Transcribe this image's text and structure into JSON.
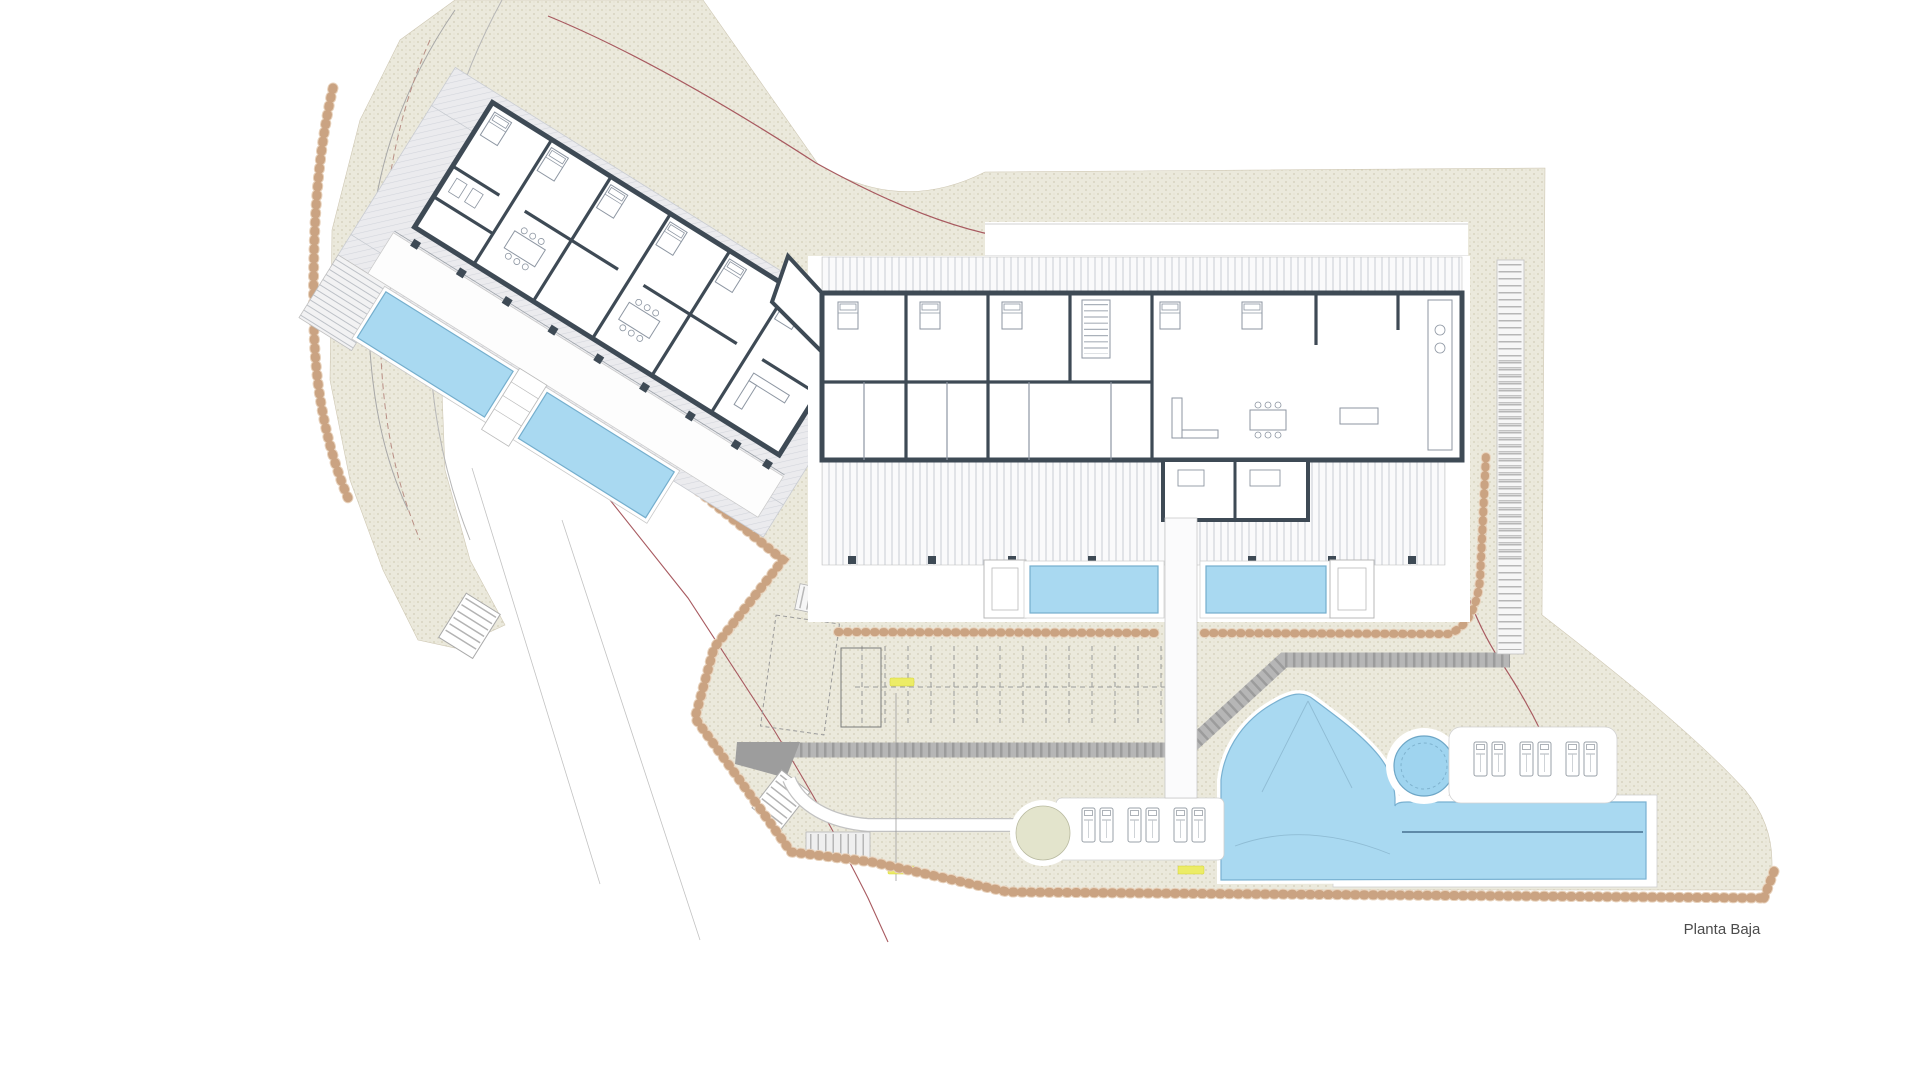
{
  "title": {
    "label": "Planta Baja"
  },
  "plan": {
    "kind": "residential ground-floor site plan",
    "west_block": {
      "name": "west apartment block",
      "rotation_deg": 32,
      "private_pools": 2
    },
    "east_block": {
      "name": "east apartment block",
      "rotation_deg": 0,
      "private_pools": 2
    },
    "amenities": {
      "lagoon_pool": 1,
      "lap_pool_lane_lines": 1,
      "spa_circle": 1,
      "sun_loungers_upper_deck": 6,
      "sun_loungers_lower_deck": 6,
      "planting_circle": 1,
      "parking_stalls_marked": true,
      "stairs": 4
    },
    "elevation_marks": 3
  },
  "colors": {
    "pool_water": "#a9d9f1",
    "pool_edge": "#79b1d1",
    "lane_line": "#47718f",
    "terrain_base": "#ebe9dc",
    "terrain_dots": "#d3cfb8",
    "wall_dark": "#3e4a55",
    "road_gray": "#b6b6b6",
    "road_stripe": "#8f8f8f",
    "rock_border": "#c0916b",
    "plot_boundary_red": "#a85a60",
    "elevation_mark_yellow": "#ecec66",
    "hatch_terrace": "#d2d5db",
    "deck_stripe": "#c8ccd3",
    "label_text": "#4c4c4c"
  }
}
